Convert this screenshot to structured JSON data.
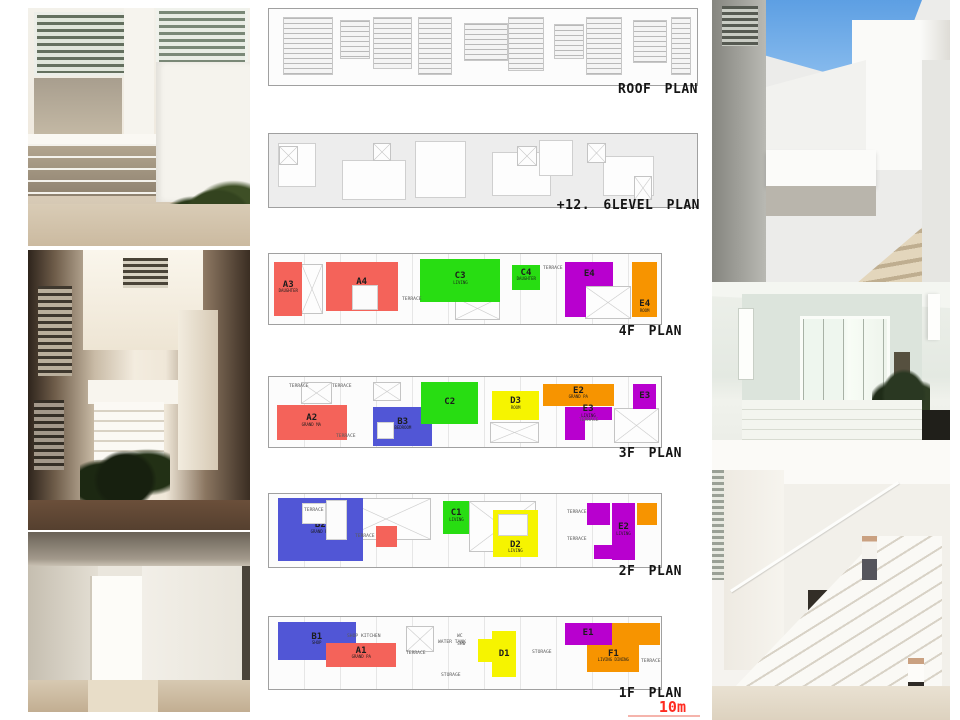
{
  "scale": {
    "label": "10m",
    "color": "#ff2b20"
  },
  "colors": {
    "unit_red": "#f4635a",
    "unit_blue": "#5156d6",
    "unit_green": "#28dd12",
    "unit_yellow": "#f6f400",
    "unit_purple": "#b800cf",
    "unit_orange": "#f79400"
  },
  "plans": [
    {
      "id": "roof",
      "label": "ROOF PLAN",
      "rooms": [],
      "cutouts": [],
      "annotations": []
    },
    {
      "id": "level126",
      "label": "+12. 6LEVEL PLAN",
      "rooms": [],
      "cutouts": [],
      "annotations": []
    },
    {
      "id": "f4",
      "label": "4F PLAN",
      "rooms": [
        {
          "label": "A3",
          "sub": "DAUGHTER",
          "color": "#f4635a",
          "rects": [
            {
              "l": 1.3,
              "t": 12,
              "w": 7.2,
              "h": 76
            }
          ]
        },
        {
          "label": "A4",
          "sub": "BEDROOM",
          "color": "#f4635a",
          "rects": [
            {
              "l": 14.5,
              "t": 12,
              "w": 18.3,
              "h": 70
            }
          ]
        },
        {
          "label": "C3",
          "sub": "LIVING",
          "color": "#28dd12",
          "rects": [
            {
              "l": 38.6,
              "t": 7,
              "w": 20.3,
              "h": 62
            }
          ]
        },
        {
          "label": "C4",
          "sub": "DAUGHTER",
          "color": "#28dd12",
          "rects": [
            {
              "l": 61.9,
              "t": 15,
              "w": 7.3,
              "h": 36
            }
          ]
        },
        {
          "label": "E4",
          "sub": "",
          "color": "#b800cf",
          "rects": [
            {
              "l": 75.6,
              "t": 12,
              "w": 12.2,
              "h": 34
            },
            {
              "l": 75.6,
              "t": 46,
              "w": 5.2,
              "h": 44
            }
          ]
        },
        {
          "label": "E4",
          "sub": "ROOM",
          "color": "#f79400",
          "labelPos": "bottom",
          "rects": [
            {
              "l": 92.6,
              "t": 12,
              "w": 6.5,
              "h": 78
            }
          ]
        }
      ],
      "cutouts": [
        {
          "l": 21.3,
          "t": 44,
          "w": 6.6,
          "h": 36
        }
      ],
      "annotations": [
        {
          "text": "TERRACE",
          "l": 34,
          "t": 60
        },
        {
          "text": "TERRACE",
          "l": 70,
          "t": 16
        }
      ]
    },
    {
      "id": "f3",
      "label": "3F PLAN",
      "rooms": [
        {
          "label": "A2",
          "sub": "GRAND MA",
          "color": "#f4635a",
          "rects": [
            {
              "l": 2,
              "t": 40,
              "w": 17.8,
              "h": 50
            }
          ]
        },
        {
          "label": "B3",
          "sub": "BEDROOM",
          "color": "#5156d6",
          "rects": [
            {
              "l": 26.6,
              "t": 43,
              "w": 15,
              "h": 55
            }
          ]
        },
        {
          "label": "C2",
          "sub": "",
          "color": "#28dd12",
          "rects": [
            {
              "l": 38.8,
              "t": 7,
              "w": 14.6,
              "h": 60
            }
          ]
        },
        {
          "label": "D3",
          "sub": "ROOM",
          "color": "#f6f400",
          "rects": [
            {
              "l": 56.9,
              "t": 20,
              "w": 12,
              "h": 42
            }
          ]
        },
        {
          "label": "E2",
          "sub": "GRAND PA",
          "color": "#f79400",
          "rects": [
            {
              "l": 69.8,
              "t": 10,
              "w": 18.3,
              "h": 32
            }
          ]
        },
        {
          "label": "E3",
          "sub": "",
          "color": "#b800cf",
          "rects": [
            {
              "l": 92.9,
              "t": 10,
              "w": 5.9,
              "h": 36
            }
          ]
        },
        {
          "label": "E3",
          "sub": "LIVING",
          "color": "#b800cf",
          "rects": [
            {
              "l": 75.4,
              "t": 43,
              "w": 12,
              "h": 19
            },
            {
              "l": 75.4,
              "t": 60,
              "w": 5.2,
              "h": 30
            }
          ]
        }
      ],
      "cutouts": [
        {
          "l": 27.5,
          "t": 64,
          "w": 4.5,
          "h": 24
        }
      ],
      "annotations": [
        {
          "text": "TERRACE",
          "l": 5,
          "t": 8
        },
        {
          "text": "TERRACE",
          "l": 16,
          "t": 8
        },
        {
          "text": "TERRACE",
          "l": 17,
          "t": 80
        },
        {
          "text": "TERRACE",
          "l": 79,
          "t": 57
        }
      ]
    },
    {
      "id": "f2",
      "label": "2F PLAN",
      "rooms": [
        {
          "label": "B2",
          "sub": "GRAND PA",
          "color": "#5156d6",
          "rects": [
            {
              "l": 2.3,
              "t": 6,
              "w": 21.6,
              "h": 86
            }
          ]
        },
        {
          "label": "",
          "sub": "",
          "color": "#f4635a",
          "rects": [
            {
              "l": 27.2,
              "t": 44,
              "w": 5.4,
              "h": 28
            }
          ]
        },
        {
          "label": "C1",
          "sub": "LIVING",
          "color": "#28dd12",
          "rects": [
            {
              "l": 44.4,
              "t": 10,
              "w": 6.7,
              "h": 45
            }
          ]
        },
        {
          "label": "D2",
          "sub": "LIVING",
          "color": "#f6f400",
          "labelPos": "bottom",
          "rects": [
            {
              "l": 57.1,
              "t": 22,
              "w": 11.5,
              "h": 65
            }
          ]
        },
        {
          "label": "E2",
          "sub": "LIVING",
          "color": "#b800cf",
          "rects": [
            {
              "l": 87.6,
              "t": 13,
              "w": 5.7,
              "h": 77
            },
            {
              "l": 81.2,
              "t": 13,
              "w": 5.7,
              "h": 30
            },
            {
              "l": 83,
              "t": 70,
              "w": 4.7,
              "h": 19
            }
          ]
        },
        {
          "label": "",
          "sub": "",
          "color": "#f79400",
          "rects": [
            {
              "l": 93.9,
              "t": 13,
              "w": 5,
              "h": 29
            }
          ]
        }
      ],
      "cutouts": [
        {
          "l": 8.4,
          "t": 13,
          "w": 6.1,
          "h": 28
        },
        {
          "l": 14.5,
          "t": 8,
          "w": 5.5,
          "h": 55
        },
        {
          "l": 58.5,
          "t": 28,
          "w": 7.5,
          "h": 30
        }
      ],
      "annotations": [
        {
          "text": "TERRACE",
          "l": 9,
          "t": 18
        },
        {
          "text": "TERRACE",
          "l": 22,
          "t": 54
        },
        {
          "text": "TERRACE",
          "l": 76,
          "t": 20
        },
        {
          "text": "TERRACE",
          "l": 76,
          "t": 58
        }
      ]
    },
    {
      "id": "f1",
      "label": "1F PLAN",
      "rooms": [
        {
          "label": "B1",
          "sub": "SHOP",
          "color": "#5156d6",
          "rects": [
            {
              "l": 2.3,
              "t": 7,
              "w": 19.8,
              "h": 53
            }
          ]
        },
        {
          "label": "A1",
          "sub": "GRAND PA",
          "color": "#f4635a",
          "rects": [
            {
              "l": 14.5,
              "t": 36,
              "w": 18,
              "h": 34
            }
          ]
        },
        {
          "label": "D1",
          "sub": "",
          "color": "#f6f400",
          "rects": [
            {
              "l": 56.9,
              "t": 20,
              "w": 6.2,
              "h": 64
            },
            {
              "l": 53.3,
              "t": 30,
              "w": 3.7,
              "h": 32
            }
          ]
        },
        {
          "label": "E1",
          "sub": "",
          "color": "#b800cf",
          "rects": [
            {
              "l": 75.4,
              "t": 8,
              "w": 12,
              "h": 31
            }
          ]
        },
        {
          "label": "F1",
          "sub": "LIVING DINING",
          "color": "#f79400",
          "labelRect": 1,
          "rects": [
            {
              "l": 87.6,
              "t": 8,
              "w": 12.2,
              "h": 31
            },
            {
              "l": 81.2,
              "t": 39,
              "w": 13.3,
              "h": 37
            }
          ]
        }
      ],
      "cutouts": [],
      "annotations": [
        {
          "text": "SHOP KITCHEN",
          "l": 20,
          "t": 22
        },
        {
          "text": "WC",
          "l": 48,
          "t": 22
        },
        {
          "text": "SHW",
          "l": 48,
          "t": 33
        },
        {
          "text": "WATER TANK",
          "l": 43,
          "t": 30
        },
        {
          "text": "TERRACE",
          "l": 35,
          "t": 46
        },
        {
          "text": "STORAGE",
          "l": 44,
          "t": 76
        },
        {
          "text": "STORAGE",
          "l": 67,
          "t": 44
        },
        {
          "text": "TERRACE",
          "l": 95,
          "t": 57
        }
      ]
    }
  ]
}
